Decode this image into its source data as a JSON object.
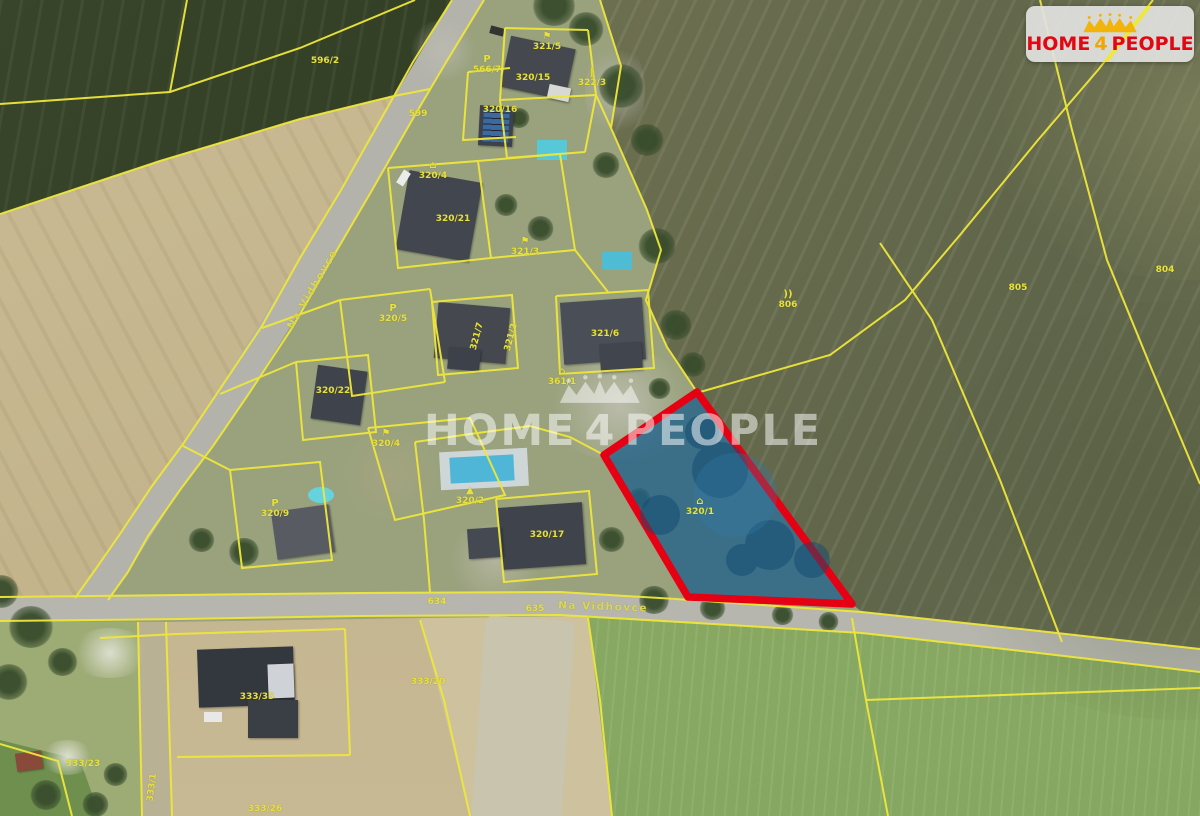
{
  "logo": {
    "left": "HOME",
    "mid": "4",
    "right": "PEOPLE",
    "icon": "crown-of-houses-and-people",
    "background": "#e2e2df",
    "text_color": "#e30613",
    "accent_color": "#f0a800"
  },
  "watermark": {
    "left": "HOME",
    "mid": "4",
    "right": "PEOPLE",
    "icon": "crown-of-houses-and-people",
    "color": "rgba(255,255,255,0.52)"
  },
  "map": {
    "type": "cadastral-aerial-map",
    "colors": {
      "parcel_line": "#efe73a",
      "highlight_outline": "#e60014",
      "highlight_fill": "#20618c"
    },
    "highlight": {
      "parcel_number": "320/1"
    },
    "labels": [
      {
        "text": "596/2",
        "x": 325,
        "y": 62
      },
      {
        "text": "599",
        "x": 418,
        "y": 115
      },
      {
        "text": "321/5",
        "x": 547,
        "y": 43,
        "sym": "⚑"
      },
      {
        "text": "320/15",
        "x": 533,
        "y": 79
      },
      {
        "text": "322/3",
        "x": 592,
        "y": 79,
        "sym": "‖"
      },
      {
        "text": "320/16",
        "x": 500,
        "y": 111
      },
      {
        "text": "566/7",
        "x": 487,
        "y": 66,
        "sym": "P"
      },
      {
        "text": "320/4",
        "x": 433,
        "y": 172,
        "sym": "⌂"
      },
      {
        "text": "320/21",
        "x": 453,
        "y": 220
      },
      {
        "text": "321/3",
        "x": 525,
        "y": 248,
        "sym": "⚑"
      },
      {
        "text": "320/5",
        "x": 393,
        "y": 315,
        "sym": "P"
      },
      {
        "text": "321/7",
        "x": 478,
        "y": 337,
        "rot": -75
      },
      {
        "text": "321/2",
        "x": 512,
        "y": 338,
        "rot": -75
      },
      {
        "text": "321/6",
        "x": 605,
        "y": 335
      },
      {
        "text": "361/1",
        "x": 562,
        "y": 378,
        "sym": "⌂"
      },
      {
        "text": "320/22",
        "x": 333,
        "y": 392
      },
      {
        "text": "320/4",
        "x": 386,
        "y": 440,
        "sym": "⚑"
      },
      {
        "text": "320/9",
        "x": 275,
        "y": 510,
        "sym": "P"
      },
      {
        "text": "320/2",
        "x": 470,
        "y": 497,
        "sym": "▲"
      },
      {
        "text": "320/17",
        "x": 547,
        "y": 536
      },
      {
        "text": "320/1",
        "x": 700,
        "y": 508,
        "sym": "⌂"
      },
      {
        "text": "806",
        "x": 788,
        "y": 301,
        "sym": "))"
      },
      {
        "text": "805",
        "x": 1018,
        "y": 289
      },
      {
        "text": "804",
        "x": 1165,
        "y": 271
      },
      {
        "text": "333/23",
        "x": 83,
        "y": 765
      },
      {
        "text": "333/1",
        "x": 153,
        "y": 788,
        "rot": -83
      },
      {
        "text": "333/35",
        "x": 257,
        "y": 698
      },
      {
        "text": "333/26",
        "x": 265,
        "y": 810
      },
      {
        "text": "333/20",
        "x": 428,
        "y": 683
      },
      {
        "text": "635",
        "x": 535,
        "y": 610
      },
      {
        "text": "634",
        "x": 437,
        "y": 603
      },
      {
        "text": "Na Vidhovce",
        "x": 603,
        "y": 608,
        "rot": 2,
        "kind": "road"
      },
      {
        "text": "Na Vidhovce",
        "x": 313,
        "y": 290,
        "rot": -60,
        "kind": "road"
      }
    ]
  }
}
